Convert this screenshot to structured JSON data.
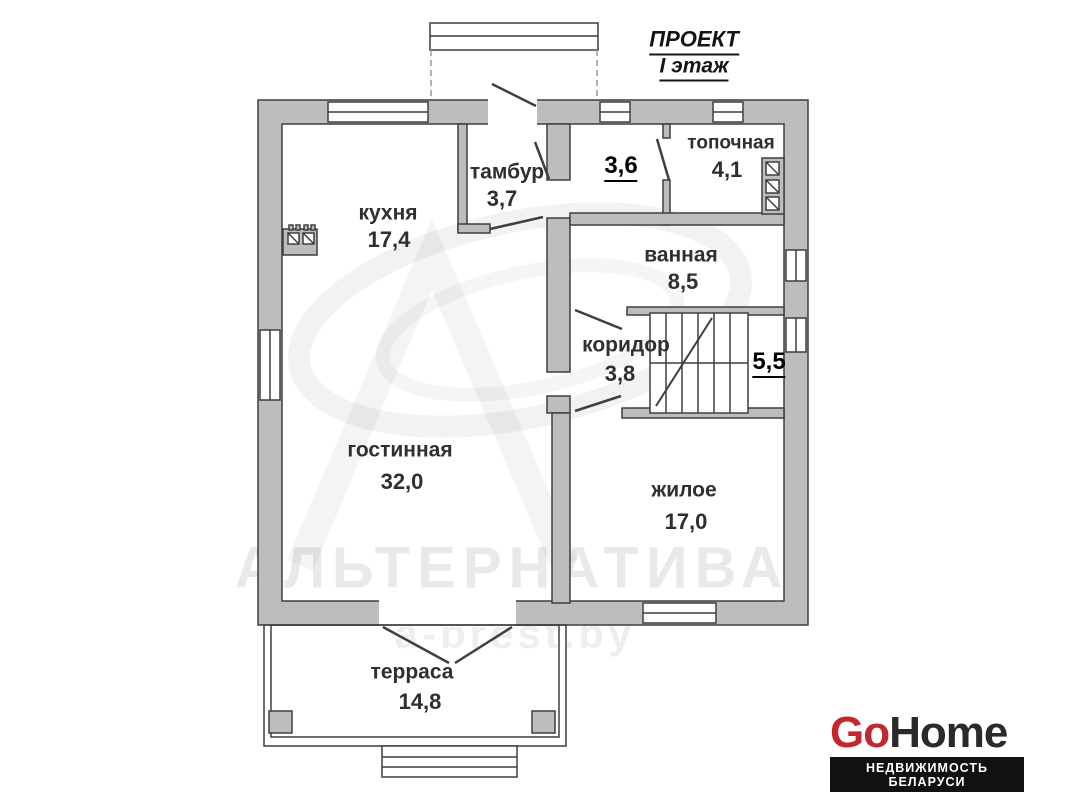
{
  "title": {
    "line1": "ПРОЕКТ",
    "line2": "I этаж"
  },
  "rooms": {
    "kitchen": {
      "label": "кухня",
      "area": "17,4"
    },
    "vestibule": {
      "label": "тамбур",
      "area": "3,7"
    },
    "storage": {
      "area": "3,6"
    },
    "boiler": {
      "label": "топочная",
      "area": "4,1"
    },
    "bathroom": {
      "label": "ванная",
      "area": "8,5"
    },
    "corridor": {
      "label": "коридор",
      "area": "3,8"
    },
    "stairwell": {
      "area": "5,5"
    },
    "living": {
      "label": "гостинная",
      "area": "32,0"
    },
    "bedroom": {
      "label": "жилое",
      "area": "17,0"
    },
    "terrace": {
      "label": "терраса",
      "area": "14,8"
    }
  },
  "watermark": {
    "line1": "АЛЬТЕРНАТИВА",
    "line2": "a-brest.by"
  },
  "logo": {
    "part1": "Go",
    "part2": "Home",
    "tagline": "НЕДВИЖИМОСТЬ БЕЛАРУСИ",
    "red": "#c4272d",
    "dark": "#2b2a2a"
  },
  "colors": {
    "wall_fill": "#bdbdbd",
    "line": "#3f3f3f"
  }
}
